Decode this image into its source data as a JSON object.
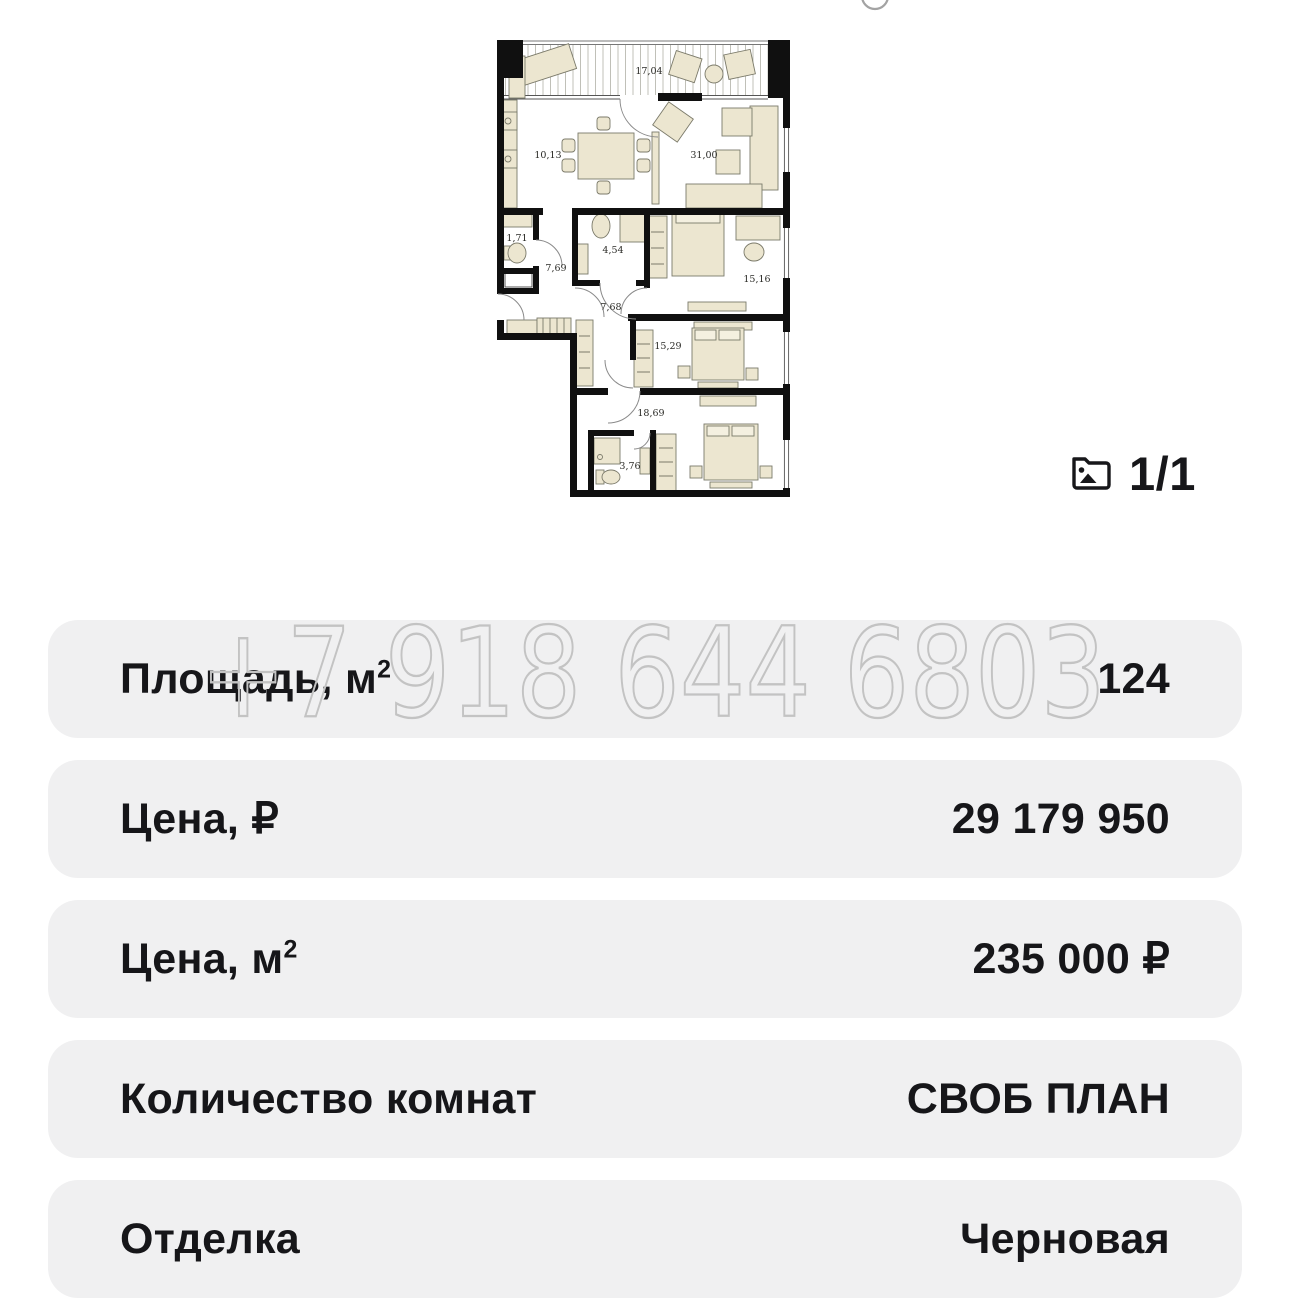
{
  "watermark": {
    "phone": "+7 918 644 6803",
    "color": "#c3c3c3"
  },
  "gallery": {
    "counter": "1/1",
    "icon": "photo-icon"
  },
  "floorplan": {
    "rooms": {
      "balcony": "17,04",
      "kitchen": "10,13",
      "living": "31,00",
      "wc": "1,71",
      "hall1": "7,69",
      "bathroom1": "4,54",
      "hall2": "7,68",
      "bedroom1": "15,16",
      "bedroom2": "15,29",
      "bedroom3": "18,69",
      "bathroom2": "3,76"
    },
    "colors": {
      "walls": "#101010",
      "furniture": "#ece6d0",
      "hatch": "#b9b9b0"
    }
  },
  "details": {
    "row_background": "#f0f0f1",
    "rows": [
      {
        "label": "Площадь, м",
        "sup": "2",
        "value": "124"
      },
      {
        "label": "Цена, ₽",
        "sup": "",
        "value": "29 179 950"
      },
      {
        "label": "Цена, м",
        "sup": "2",
        "value": "235 000 ₽"
      },
      {
        "label": "Количество комнат",
        "sup": "",
        "value": "СВОБ ПЛАН"
      },
      {
        "label": "Отделка",
        "sup": "",
        "value": "Черновая"
      }
    ]
  }
}
